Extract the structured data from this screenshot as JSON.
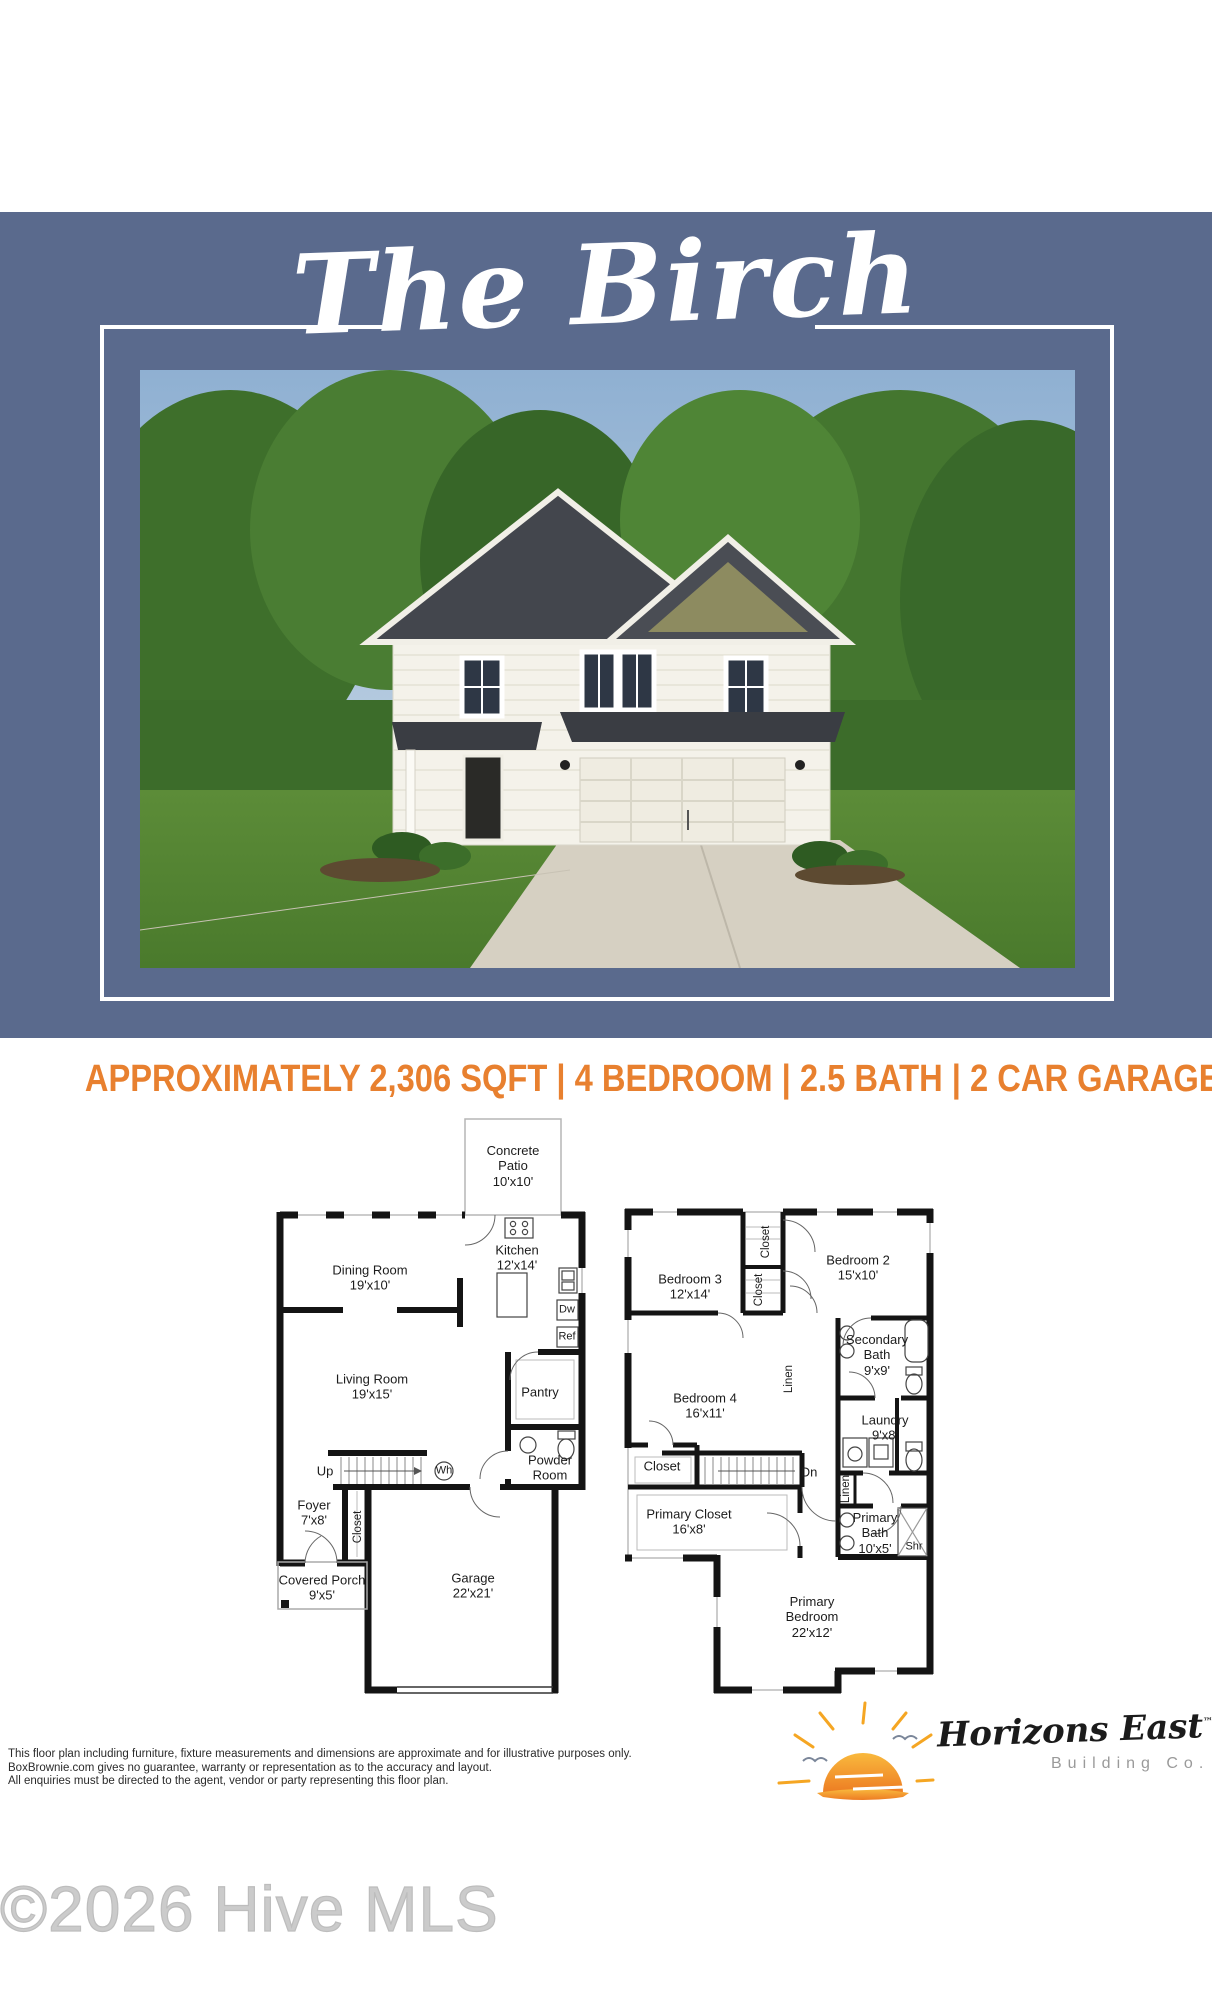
{
  "title": "The Birch",
  "specs_line": "APPROXIMATELY 2,306 SQFT | 4 BEDROOM | 2.5 BATH | 2 CAR GARAGE",
  "colors": {
    "header_blue": "#5a6a8d",
    "accent_orange": "#e8802f",
    "sun_orange": "#f5a623",
    "wall_black": "#141414"
  },
  "floorplans": {
    "first": {
      "labels": [
        {
          "name": "Concrete\nPatio",
          "dims": "10'x10'"
        },
        {
          "name": "Dining Room",
          "dims": "19'x10'"
        },
        {
          "name": "Kitchen",
          "dims": "12'x14'"
        },
        {
          "name": "Dw",
          "dims": ""
        },
        {
          "name": "Ref",
          "dims": ""
        },
        {
          "name": "Living Room",
          "dims": "19'x15'"
        },
        {
          "name": "Pantry",
          "dims": ""
        },
        {
          "name": "Up",
          "dims": ""
        },
        {
          "name": "Wh",
          "dims": ""
        },
        {
          "name": "Powder\nRoom",
          "dims": ""
        },
        {
          "name": "Foyer",
          "dims": "7'x8'"
        },
        {
          "name": "Closet",
          "dims": ""
        },
        {
          "name": "Covered Porch",
          "dims": "9'x5'"
        },
        {
          "name": "Garage",
          "dims": "22'x21'"
        }
      ]
    },
    "second": {
      "labels": [
        {
          "name": "Bedroom 3",
          "dims": "12'x14'"
        },
        {
          "name": "Closet",
          "dims": ""
        },
        {
          "name": "Closet",
          "dims": ""
        },
        {
          "name": "Bedroom 2",
          "dims": "15'x10'"
        },
        {
          "name": "Secondary\nBath",
          "dims": "9'x9'"
        },
        {
          "name": "Bedroom 4",
          "dims": "16'x11'"
        },
        {
          "name": "Linen",
          "dims": ""
        },
        {
          "name": "Laundry",
          "dims": "9'x8'"
        },
        {
          "name": "Closet",
          "dims": ""
        },
        {
          "name": "Dn",
          "dims": ""
        },
        {
          "name": "Linen",
          "dims": ""
        },
        {
          "name": "Primary Closet",
          "dims": "16'x8'"
        },
        {
          "name": "Primary\nBath",
          "dims": "10'x5'"
        },
        {
          "name": "Shr",
          "dims": ""
        },
        {
          "name": "Primary\nBedroom",
          "dims": "22'x12'"
        }
      ]
    }
  },
  "disclaimer": {
    "line1": "This floor plan including furniture, fixture measurements and dimensions are approximate and for illustrative purposes only.",
    "line2": "BoxBrownie.com gives no guarantee, warranty or representation as to the accuracy and layout.",
    "line3": "All enquiries must be directed to the agent, vendor or party representing this floor plan."
  },
  "logo": {
    "name": "Horizons East",
    "tm": "™",
    "tagline": "Building Co."
  },
  "watermark": "©2026 Hive MLS"
}
